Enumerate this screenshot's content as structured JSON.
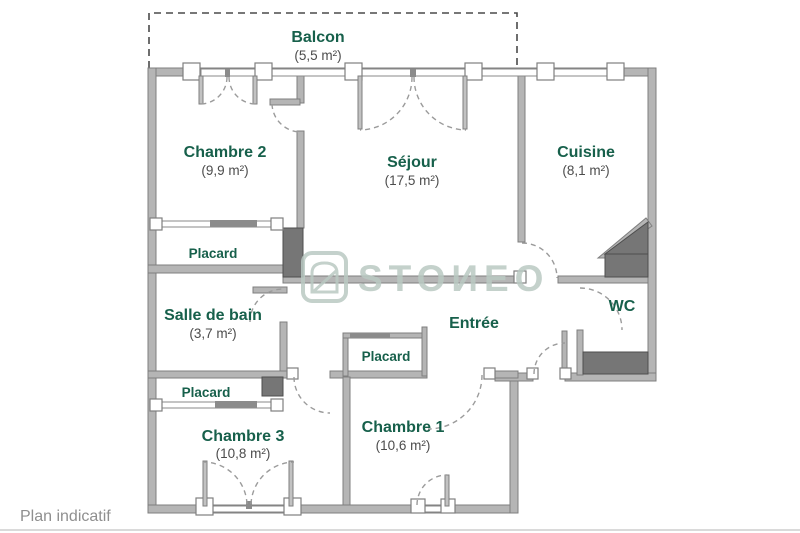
{
  "plan": {
    "balcony": {
      "name": "Balcon",
      "area": "(5,5 m²)"
    },
    "rooms": [
      {
        "id": "chambre-2",
        "name": "Chambre 2",
        "area": "(9,9 m²)"
      },
      {
        "id": "sejour",
        "name": "Séjour",
        "area": "(17,5 m²)"
      },
      {
        "id": "cuisine",
        "name": "Cuisine",
        "area": "(8,1 m²)"
      },
      {
        "id": "salle-de-bain",
        "name": "Salle de bain",
        "area": "(3,7 m²)"
      },
      {
        "id": "wc",
        "name": "WC",
        "area": ""
      },
      {
        "id": "entree",
        "name": "Entrée",
        "area": ""
      },
      {
        "id": "chambre-1",
        "name": "Chambre 1",
        "area": "(10,6 m²)"
      },
      {
        "id": "chambre-3",
        "name": "Chambre 3",
        "area": "(10,8 m²)"
      }
    ],
    "closets": [
      {
        "label": "Placard"
      },
      {
        "label": "Placard"
      },
      {
        "label": "Placard"
      }
    ]
  },
  "watermark": {
    "brand": "STOИEO"
  },
  "footer": {
    "note": "Plan indicatif"
  },
  "colors": {
    "room_label_green": "#17604b",
    "area_gray": "#4c4c4c",
    "wall_gray": "#b5b5b5",
    "duct_dark_gray": "#767676",
    "watermark_sage": "#bac9c3"
  }
}
